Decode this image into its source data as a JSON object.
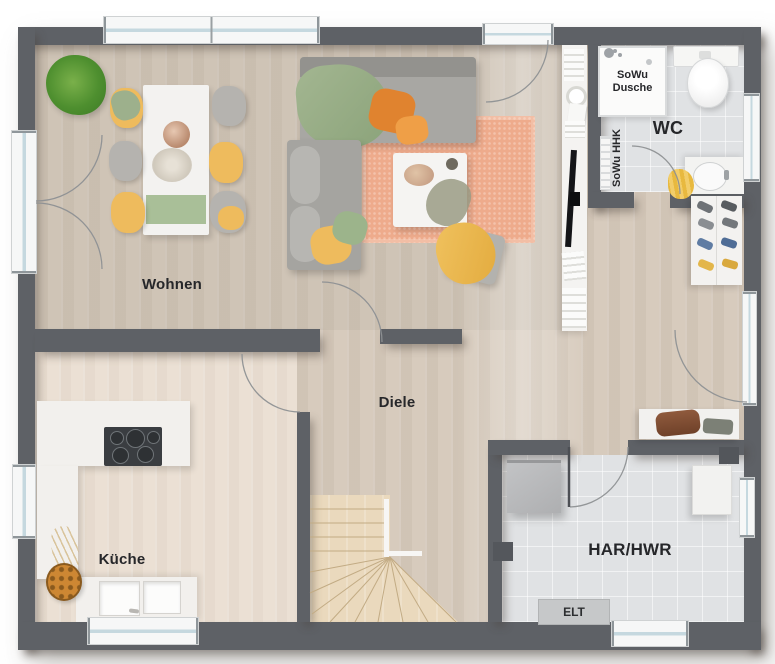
{
  "rooms": {
    "wohnen": {
      "label": "Wohnen"
    },
    "wc": {
      "label": "WC"
    },
    "diele": {
      "label": "Diele"
    },
    "kueche": {
      "label": "Küche"
    },
    "har_hwr": {
      "label": "HAR/HWR"
    }
  },
  "fixtures": {
    "shower_label_line1": "SoWu",
    "shower_label_line2": "Dusche",
    "towel_radiator_label": "SoWu HHK",
    "elt_label": "ELT"
  },
  "colors": {
    "wall": "#5e6166",
    "wood_floor": "#d7cbbd",
    "kitchen_floor": "#ebe0d4",
    "tile_floor": "#e0e2e4",
    "stair_wood": "#ead9bd",
    "rug": "#eeab8c",
    "accent_yellow": "#eebb5d",
    "accent_green": "#9cb48b",
    "accent_orange": "#e0832f"
  }
}
